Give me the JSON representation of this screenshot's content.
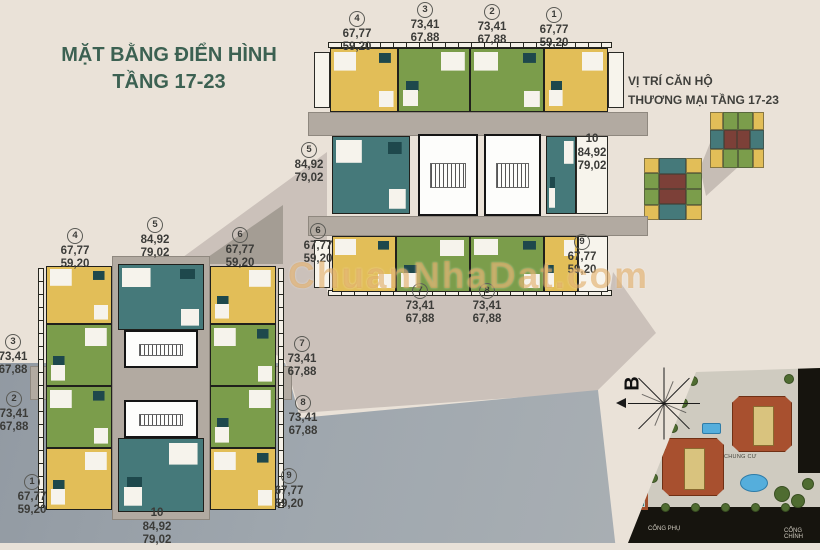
{
  "main_title": {
    "line1": "MẶT BẰNG ĐIỂN HÌNH",
    "line2": "TẦNG 17-23"
  },
  "key_plan": {
    "title_line1": "VỊ TRÍ CĂN HỘ",
    "title_line2": "THƯƠNG MẠI TẦNG 17-23"
  },
  "watermark": "ChuanNhaDat.com",
  "compass": {
    "north_label": "B"
  },
  "site_plan": {
    "building_label": "CHUNG CƯ",
    "gate_secondary": "CỔNG PHỤ",
    "gate_main": "CỔNG CHÍNH"
  },
  "tower_a": {
    "u1": {
      "no": "1",
      "area1": "67,77",
      "area2": "59,20"
    },
    "u2": {
      "no": "2",
      "area1": "73,41",
      "area2": "67,88"
    },
    "u3": {
      "no": "3",
      "area1": "73,41",
      "area2": "67,88"
    },
    "u4": {
      "no": "4",
      "area1": "67,77",
      "area2": "59,20"
    },
    "u5": {
      "no": "5",
      "area1": "84,92",
      "area2": "79,02"
    },
    "u6": {
      "no": "6",
      "area1": "67,77",
      "area2": "59,20"
    },
    "u7": {
      "no": "7",
      "area1": "73,41",
      "area2": "67,88"
    },
    "u8": {
      "no": "8",
      "area1": "73,41",
      "area2": "67,88"
    },
    "u9": {
      "no": "9",
      "area1": "67,77",
      "area2": "59,20"
    },
    "u10": {
      "no": "10",
      "area1": "84,92",
      "area2": "79,02"
    }
  },
  "tower_b": {
    "u1": {
      "no": "1",
      "area1": "67,77",
      "area2": "59,20"
    },
    "u2": {
      "no": "2",
      "area1": "73,41",
      "area2": "67,88"
    },
    "u3": {
      "no": "3",
      "area1": "73,41",
      "area2": "67,88"
    },
    "u4": {
      "no": "4",
      "area1": "67,77",
      "area2": "59,20"
    },
    "u5": {
      "no": "5",
      "area1": "84,92",
      "area2": "79,02"
    },
    "u6": {
      "no": "6",
      "area1": "67,77",
      "area2": "59,20"
    },
    "u7": {
      "no": "7",
      "area1": "73,41",
      "area2": "67,88"
    },
    "u8": {
      "no": "8",
      "area1": "73,41",
      "area2": "67,88"
    },
    "u9": {
      "no": "9",
      "area1": "67,77",
      "area2": "59,20"
    },
    "u10": {
      "no": "10",
      "area1": "84,92",
      "area2": "79,02"
    }
  },
  "colors": {
    "background": "#EAE2D8",
    "wedge": "#CBC1BA",
    "corridor": "#B2AAA1",
    "yellow_c": "#E2BE58",
    "green_c": "#7B9D4B",
    "teal_c": "#45797A",
    "title": "#3C6152",
    "watermark_c": "#DB9D4A"
  }
}
